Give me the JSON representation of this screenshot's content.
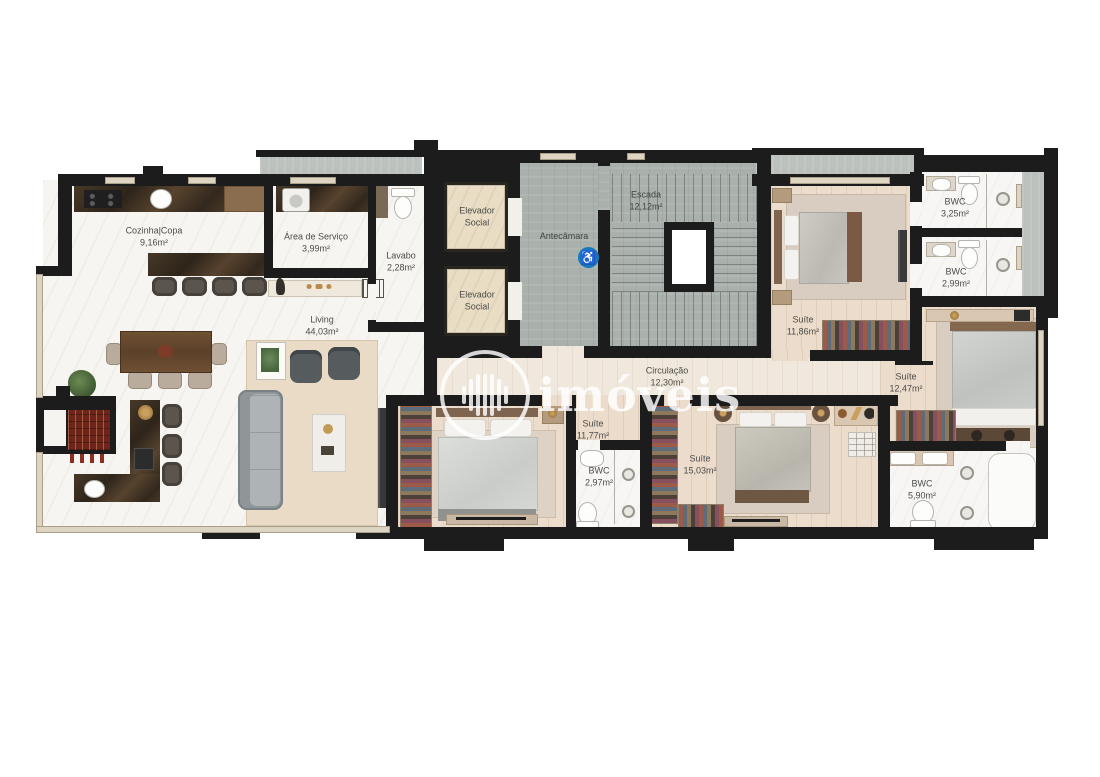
{
  "plan_title": "Floor plan (pavimento tipo)",
  "watermark": {
    "text": "imóveis"
  },
  "icons": {
    "accessibility": "♿"
  },
  "colors": {
    "wall": "#1c1c1c",
    "concrete": "#aab0ac",
    "wood_floor": "#ecdccb",
    "marble_floor": "#f7f5f1",
    "dark_counter": "#3a2f22",
    "bathtub_teal": "#4fb6c9",
    "accessibility_blue": "#1878be",
    "watermark_white": "rgba(255,255,255,0.82)"
  },
  "rooms": {
    "cozinha": {
      "name": "Cozinha|Copa",
      "area": "9,16m²"
    },
    "servico": {
      "name": "Área de Serviço",
      "area": "3,99m²"
    },
    "lavabo": {
      "name": "Lavabo",
      "area": "2,28m²"
    },
    "elevador1": {
      "name": "Elevador Social"
    },
    "elevador2": {
      "name": "Elevador Social"
    },
    "antecamara": {
      "name": "Antecâmara"
    },
    "escada": {
      "name": "Escada",
      "area": "12,12m²"
    },
    "living": {
      "name": "Living",
      "area": "44,03m²"
    },
    "circulacao": {
      "name": "Circulação",
      "area": "12,30m²"
    },
    "suite1186": {
      "name": "Suíte",
      "area": "11,86m²"
    },
    "bwc325": {
      "name": "BWC",
      "area": "3,25m²"
    },
    "bwc299": {
      "name": "BWC",
      "area": "2,99m²"
    },
    "suite1247": {
      "name": "Suíte",
      "area": "12,47m²"
    },
    "suite1177": {
      "name": "Suíte",
      "area": "11,77m²"
    },
    "bwc297": {
      "name": "BWC",
      "area": "2,97m²"
    },
    "suite1503": {
      "name": "Suíte",
      "area": "15,03m²"
    },
    "bwc590": {
      "name": "BWC",
      "area": "5,90m²"
    }
  }
}
